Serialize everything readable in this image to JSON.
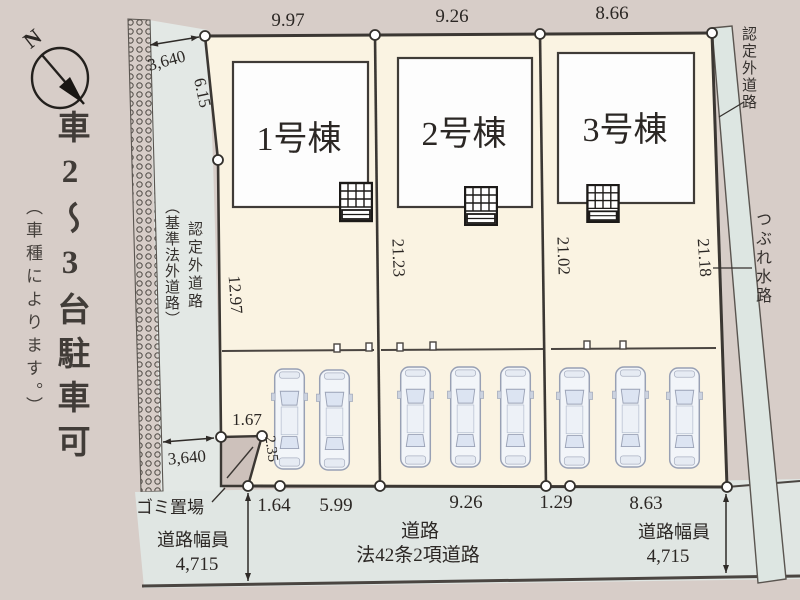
{
  "side_note": {
    "main": "車2〜3台駐車可",
    "sub": "（車種によります。）"
  },
  "compass": {
    "north": "N"
  },
  "plots": {
    "buildings": [
      {
        "label": "1号棟"
      },
      {
        "label": "2号棟"
      },
      {
        "label": "3号棟"
      }
    ]
  },
  "dims": {
    "top": [
      "9.97",
      "9.26",
      "8.66"
    ],
    "offset_top": "3,640",
    "offset_bottom": "3,640",
    "left_upper": "6.15",
    "left_lower": "12.97",
    "depth_1": "21.23",
    "depth_2": "21.02",
    "depth_3": "21.18",
    "notch_w": "1.67",
    "notch_h": "2.35",
    "bottom": [
      "1.64",
      "5.99",
      "9.26",
      "1.29",
      "8.63"
    ]
  },
  "roads": {
    "left_label_main": "認定外道路",
    "left_label_sub": "（基準法外道路）",
    "right_top": "認定外道路",
    "right_water": "つぶれ水路",
    "bottom_name": "道路",
    "bottom_type": "法42条2項道路",
    "width_label_left": "道路幅員",
    "width_value_left": "4,715",
    "width_label_right": "道路幅員",
    "width_value_right": "4,715"
  },
  "facilities": {
    "garbage": "ゴミ置場"
  },
  "colors": {
    "background": "#d7cdc8",
    "road": "#e3e8e5",
    "plot": "#faf3e2",
    "building": "#fdfdfd",
    "water": "#dde6e2",
    "line": "#3b3b3b"
  }
}
